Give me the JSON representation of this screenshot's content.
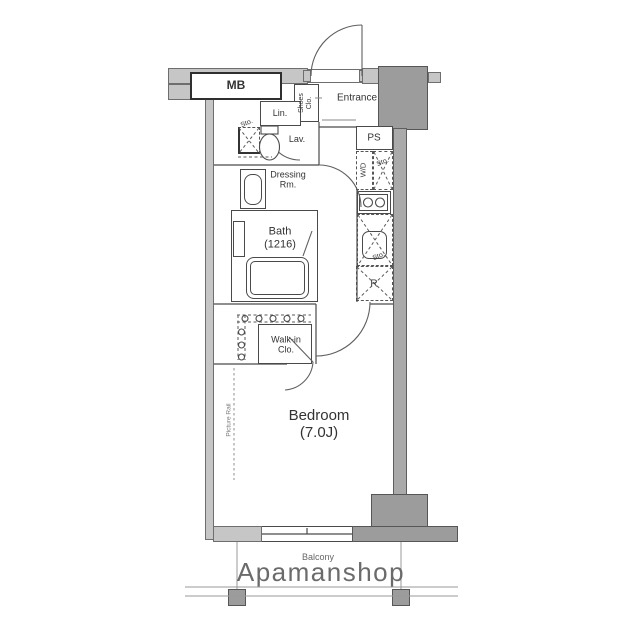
{
  "floorplan": {
    "rooms": {
      "mb": "MB",
      "entrance": "Entrance",
      "shoes_closet_line1": "Shoes",
      "shoes_closet_line2": "Clo.",
      "linen": "Lin.",
      "hall_storage": "Sto.",
      "lavatory": "Lav.",
      "dressing_line1": "Dressing",
      "dressing_line2": "Rm.",
      "bath_line1": "Bath",
      "bath_line2": "(1216)",
      "pipe_space": "PS",
      "washer_dryer": "W/D",
      "laundry_storage": "Sto.",
      "kitchen_storage": "Sto.",
      "refrigerator": "R",
      "walkin_line1": "Walk-in",
      "walkin_line2": "Clo.",
      "bedroom_line1": "Bedroom",
      "bedroom_line2": "(7.0J)",
      "picture_rail": "Picture Rail",
      "balcony": "Balcony"
    },
    "watermark": "Apamanshop",
    "colors": {
      "wall_light": "#c6c6c6",
      "wall_dark": "#9c9c9c",
      "line": "#4a4a4a",
      "watermark_gray": "#6b6b6b"
    }
  }
}
